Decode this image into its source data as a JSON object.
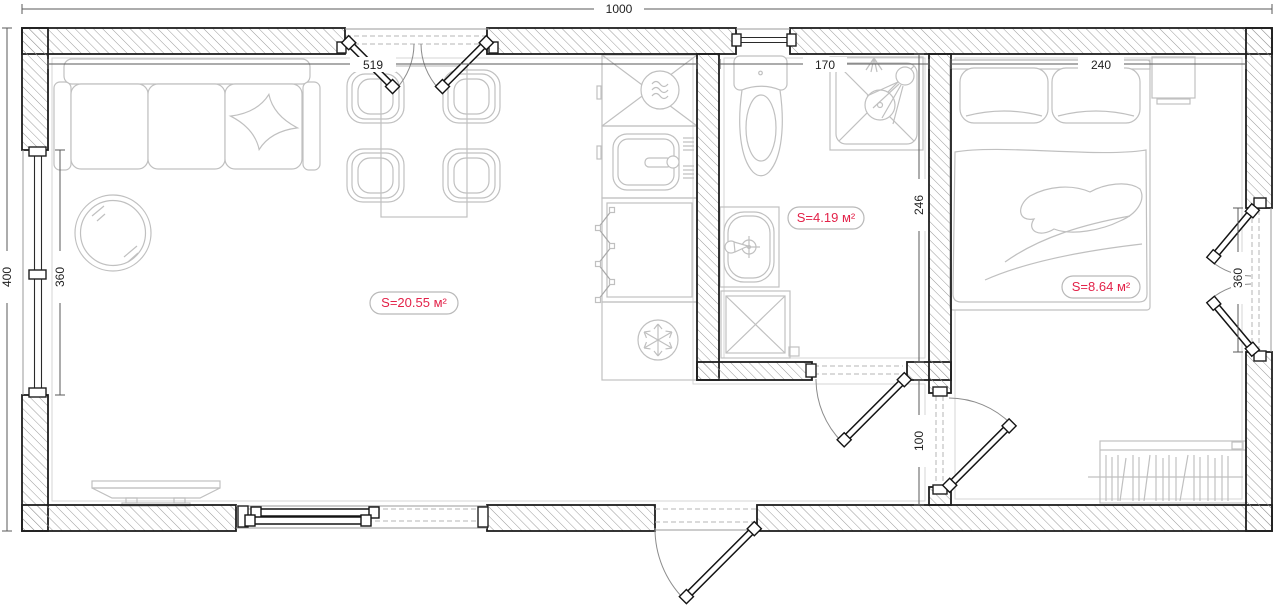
{
  "plan": {
    "type": "apartment-floor-plan",
    "colors": {
      "background": "#ffffff",
      "wall_outline": "#1f1f1f",
      "wall_hatch": "#9b9b9b",
      "furniture_line": "#c0c0c0",
      "door_line": "#141414",
      "dimension_line": "#5a5a5a",
      "dimension_text": "#1f1f1f",
      "area_label_text": "#e32249",
      "area_label_border": "#b9b9b9"
    },
    "dimensions": {
      "overall_width": "1000",
      "overall_depth": "400",
      "living_width": "519",
      "left_window_height": "360",
      "bathroom_width": "170",
      "bathroom_depth": "246",
      "bedroom_width": "240",
      "bedroom_window_height": "360",
      "hallway_depth": "100"
    },
    "rooms": [
      {
        "name": "living-room-kitchen",
        "area_label": "S=20.55 м²"
      },
      {
        "name": "bathroom",
        "area_label": "S=4.19 м²"
      },
      {
        "name": "bedroom",
        "area_label": "S=8.64 м²"
      }
    ]
  }
}
